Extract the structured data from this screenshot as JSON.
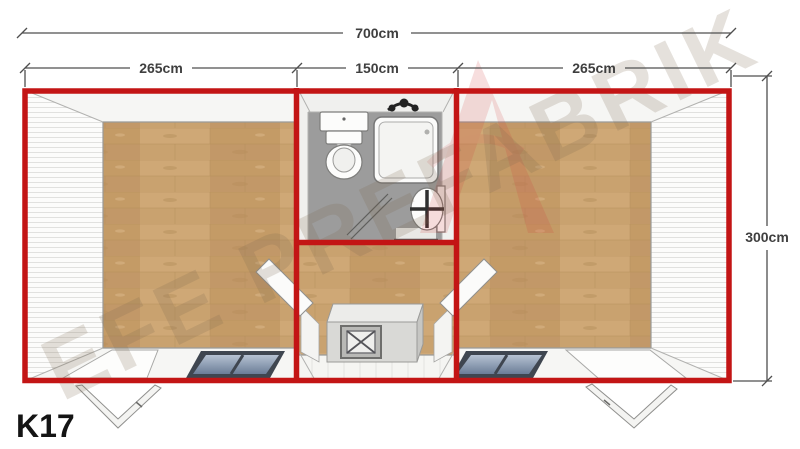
{
  "model_label": "K17",
  "watermark_text": "EFE PREFABRIK",
  "dimensions": {
    "total_width": "700cm",
    "left_room_width": "265cm",
    "bathroom_width": "150cm",
    "right_room_width": "265cm",
    "depth": "300cm"
  },
  "colors": {
    "wall_red": "#c31515",
    "wood_floor": "#c9a26f",
    "bathroom_floor": "#9c9c9c",
    "window_glass": "#6b7d97",
    "dimension_text": "#3f3f3f"
  }
}
